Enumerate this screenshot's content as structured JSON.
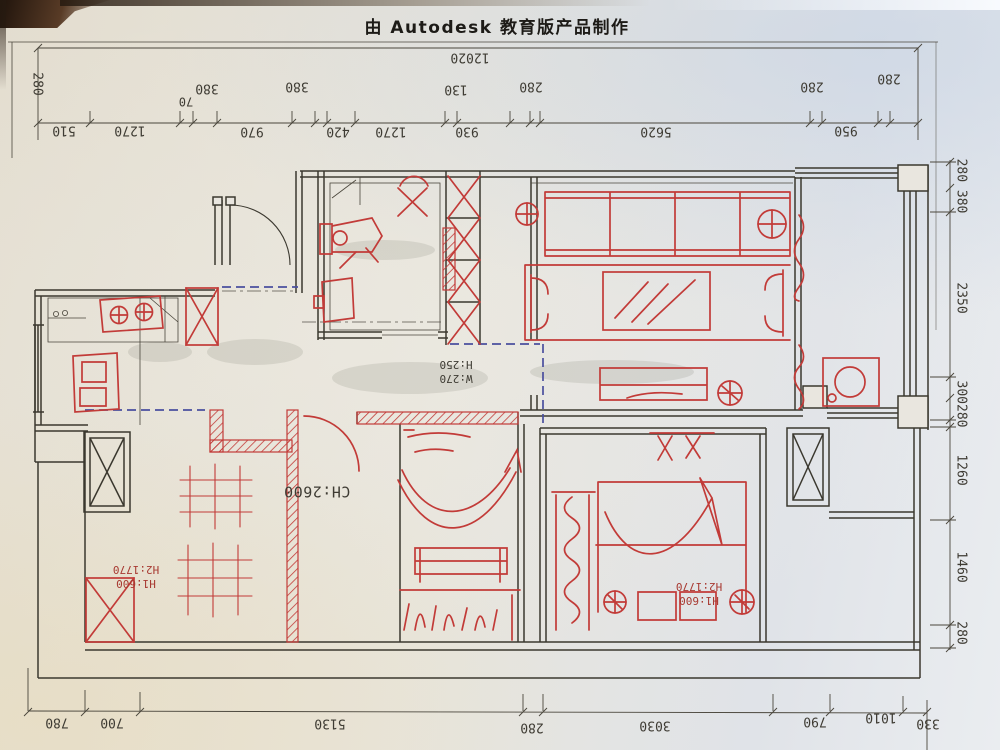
{
  "title": "由 Autodesk 教育版产品制作",
  "dims": {
    "top_total": "12020",
    "top_row2": [
      "280",
      "70",
      "380",
      "380",
      "130",
      "280",
      "280",
      "280"
    ],
    "top_chain": [
      "510",
      "1270",
      "970",
      "420",
      "1270",
      "930",
      "5620",
      "950"
    ],
    "right_chain": [
      "280 380",
      "2350",
      "300280",
      "1260",
      "1460",
      "280"
    ],
    "bottom_chain": [
      "780",
      "700",
      "5130",
      "280",
      "3030",
      "790",
      "1010",
      "330"
    ]
  },
  "notes": {
    "ceiling": "CH:2600",
    "window": {
      "l1": "W:270",
      "l2": "H:250"
    },
    "left_height": {
      "l1": "H1:600",
      "l2": "H2:1770"
    },
    "right_height": {
      "l1": "H1:600",
      "l2": "H2:1770"
    }
  },
  "colors": {
    "pen_red": "#c23b38",
    "wall_black": "#3b382f",
    "dash_blue": "#4a4f9e",
    "paper": "#e7e3da"
  }
}
